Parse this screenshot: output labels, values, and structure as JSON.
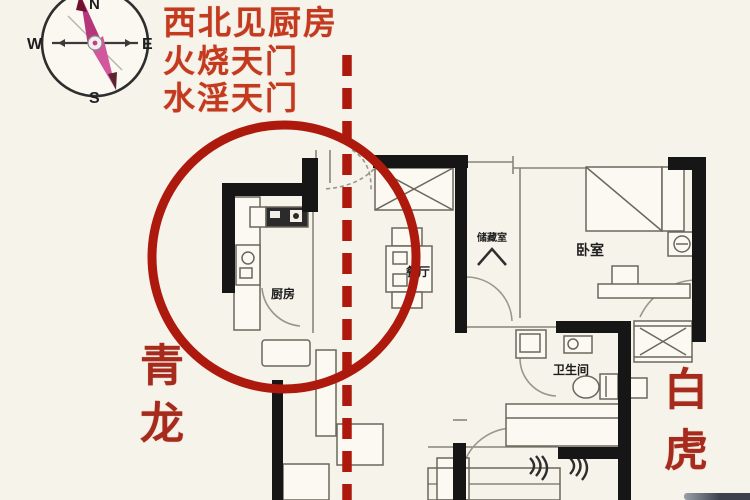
{
  "annotations": {
    "caption_lines": [
      "西北见厨房",
      "火烧天门",
      "水淫天门"
    ]
  },
  "compass": {
    "north": "N",
    "south": "S",
    "east": "E",
    "west": "W"
  },
  "sides": {
    "left_label": "青龙",
    "right_label": "白虎"
  },
  "floorplan": {
    "rooms": {
      "kitchen": "厨房",
      "dining": "餐厅",
      "storage": "储藏室",
      "bedroom": "卧室",
      "bathroom": "卫生间"
    }
  },
  "colors": {
    "accent_red": "#ad1a0d",
    "caption_red": "#c33a1f",
    "side_red": "#a62b1d",
    "wall_black": "#161616"
  }
}
